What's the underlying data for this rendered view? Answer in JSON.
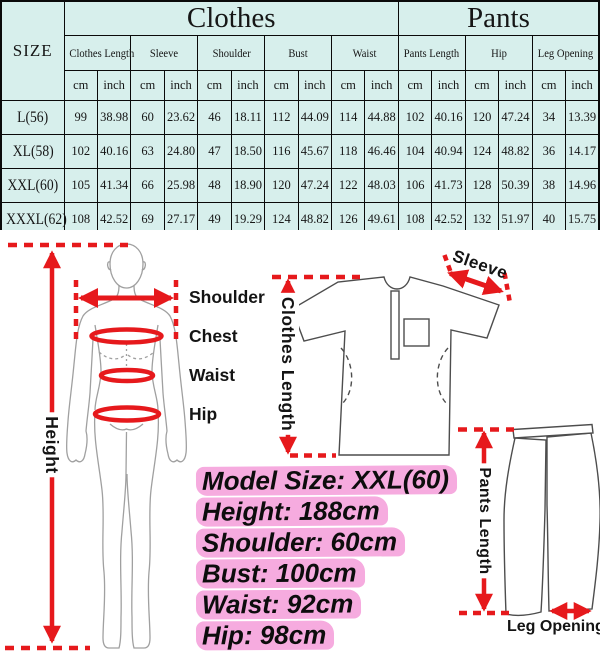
{
  "chart_data": {
    "type": "table",
    "size_header": "SIZE",
    "groups": [
      {
        "label": "Clothes",
        "columns": 10
      },
      {
        "label": "Pants",
        "columns": 6
      }
    ],
    "measures": [
      "Clothes Length",
      "Sleeve",
      "Shoulder",
      "Bust",
      "Waist",
      "Pants Length",
      "Hip",
      "Leg Opening"
    ],
    "units": [
      "cm",
      "inch"
    ],
    "rows": [
      {
        "size": "L(56)",
        "values": [
          "99",
          "38.98",
          "60",
          "23.62",
          "46",
          "18.11",
          "112",
          "44.09",
          "114",
          "44.88",
          "102",
          "40.16",
          "120",
          "47.24",
          "34",
          "13.39"
        ]
      },
      {
        "size": "XL(58)",
        "values": [
          "102",
          "40.16",
          "63",
          "24.80",
          "47",
          "18.50",
          "116",
          "45.67",
          "118",
          "46.46",
          "104",
          "40.94",
          "124",
          "48.82",
          "36",
          "14.17"
        ]
      },
      {
        "size": "XXL(60)",
        "values": [
          "105",
          "41.34",
          "66",
          "25.98",
          "48",
          "18.90",
          "120",
          "47.24",
          "122",
          "48.03",
          "106",
          "41.73",
          "128",
          "50.39",
          "38",
          "14.96"
        ]
      },
      {
        "size": "XXXL(62)",
        "values": [
          "108",
          "42.52",
          "69",
          "27.17",
          "49",
          "19.29",
          "124",
          "48.82",
          "126",
          "49.61",
          "108",
          "42.52",
          "132",
          "51.97",
          "40",
          "15.75"
        ]
      }
    ]
  },
  "diagram": {
    "body_labels": {
      "shoulder": "Shoulder",
      "chest": "Chest",
      "waist": "Waist",
      "hip": "Hip",
      "height": "Height"
    },
    "garment_labels": {
      "clothes_length": "Clothes Length",
      "sleeve": "Sleeve",
      "pants_length": "Pants Length",
      "leg_opening": "Leg Opening"
    },
    "model_info": [
      "Model Size: XXL(60)",
      "Height: 188cm",
      "Shoulder: 60cm",
      "Bust: 100cm",
      "Waist: 92cm",
      "Hip: 98cm"
    ]
  },
  "colors": {
    "measure_red": "#e6191c",
    "highlight_pink": "#f6abdf",
    "table_bg": "#d7efec",
    "garment_line": "#4d4d4d",
    "body_line": "#a0a0a0"
  }
}
